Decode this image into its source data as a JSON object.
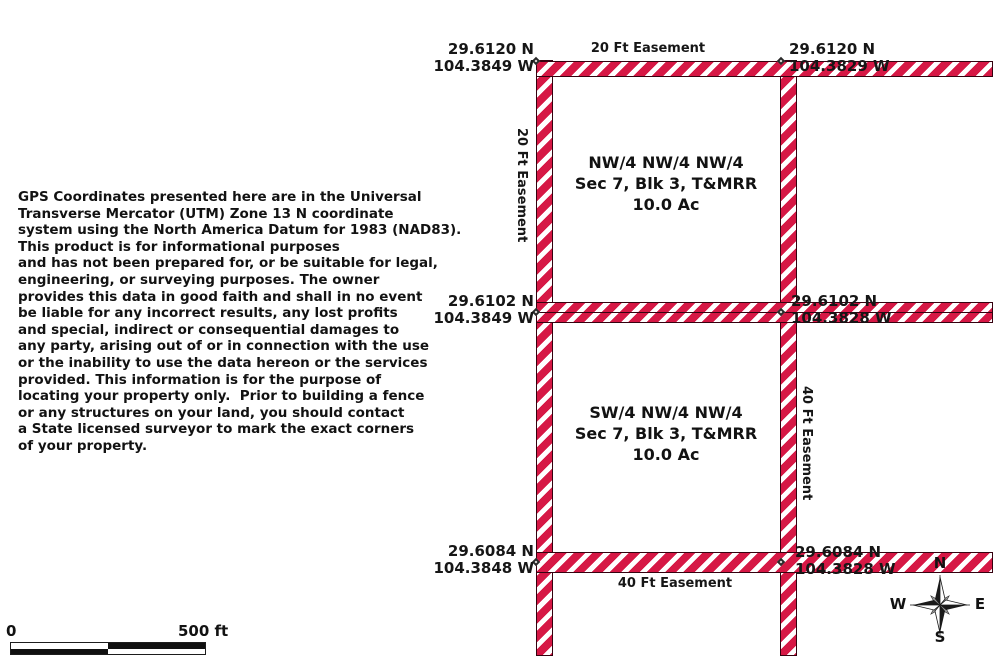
{
  "disclaimer": {
    "lines": [
      "GPS Coordinates presented here are in the Universal",
      "Transverse Mercator (UTM) Zone 13 N coordinate",
      "system using the North America Datum for 1983 (NAD83).",
      "This product is for informational purposes",
      "and has not been prepared for, or be suitable for legal,",
      "engineering, or surveying purposes. The owner",
      "provides this data in good faith and shall in no event",
      "be liable for any incorrect results, any lost profits",
      "and special, indirect or consequential damages to",
      "any party, arising out of or in connection with the use",
      "or the inability to use the data hereon or the services",
      "provided. This information is for the purpose of",
      "locating your property only.  Prior to building a fence",
      "or any structures on your land, you should contact",
      "a State licensed surveyor to mark the exact corners",
      "of your property."
    ]
  },
  "map": {
    "corner_labels": {
      "top_left": {
        "lat": "29.6120 N",
        "lon": "104.3849 W"
      },
      "top_right": {
        "lat": "29.6120 N",
        "lon": "104.3829 W"
      },
      "mid_left": {
        "lat": "29.6102 N",
        "lon": "104.3849 W"
      },
      "mid_right": {
        "lat": "29.6102 N",
        "lon": "104.3828 W"
      },
      "bottom_left": {
        "lat": "29.6084 N",
        "lon": "104.3848 W"
      },
      "bottom_right": {
        "lat": "29.6084 N",
        "lon": "104.3828 W"
      }
    },
    "easement_labels": {
      "top": "20 Ft Easement",
      "left": "20 Ft Easement",
      "right": "40 Ft Easement",
      "bottom": "40 Ft Easement"
    },
    "parcels": [
      {
        "lines": [
          "NW/4 NW/4 NW/4",
          "Sec 7, Blk 3, T&MRR",
          "10.0 Ac"
        ]
      },
      {
        "lines": [
          "SW/4 NW/4 NW/4",
          "Sec 7, Blk 3, T&MRR",
          "10.0 Ac"
        ]
      }
    ],
    "colors": {
      "easement_red": "#d61845",
      "easement_border": "#35010f",
      "text": "#121212"
    }
  },
  "scale_bar": {
    "start_label": "0",
    "end_label": "500 ft"
  },
  "compass": {
    "n": "N",
    "s": "S",
    "e": "E",
    "w": "W"
  }
}
